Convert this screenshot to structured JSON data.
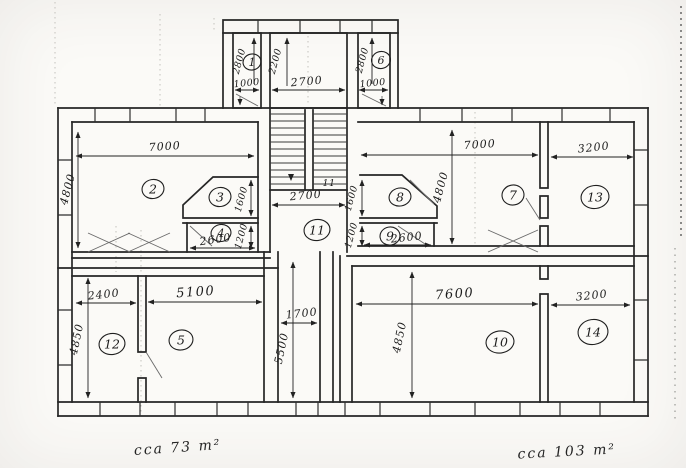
{
  "plan": {
    "room_labels": {
      "r1": "1",
      "r2": "2",
      "r3": "3",
      "r4": "4",
      "r5": "5",
      "r6": "6",
      "r7": "7",
      "r8": "8",
      "r9": "9",
      "r10": "10",
      "r11": "11",
      "r12": "12",
      "r13": "13",
      "r14": "14"
    },
    "dims": {
      "room2_w": "7000",
      "room2_h": "4800",
      "room3_h": "1600",
      "room4_w": "2600",
      "room4_h": "1200",
      "shaft1_h": "2800",
      "shaft1_w": "1000",
      "stairshaft_h": "2200",
      "stairshaft_w": "2700",
      "shaft6_h": "2800",
      "shaft6_w": "1000",
      "stairs_w": "2700",
      "stair_count": "11",
      "room8_h": "1600",
      "room9_h": "1200",
      "room9_w": "2600",
      "room7_w": "7000",
      "room7_h": "4800",
      "room13_w": "3200",
      "corridor_w": "1700",
      "corridor_h": "5500",
      "room12_w": "2400",
      "room5_w": "5100",
      "left_block_h": "4850",
      "room10_w": "7600",
      "room14_w": "3200",
      "right_block_h": "4850"
    },
    "areas": {
      "left": "cca 73 m²",
      "right": "cca 103 m²"
    }
  }
}
